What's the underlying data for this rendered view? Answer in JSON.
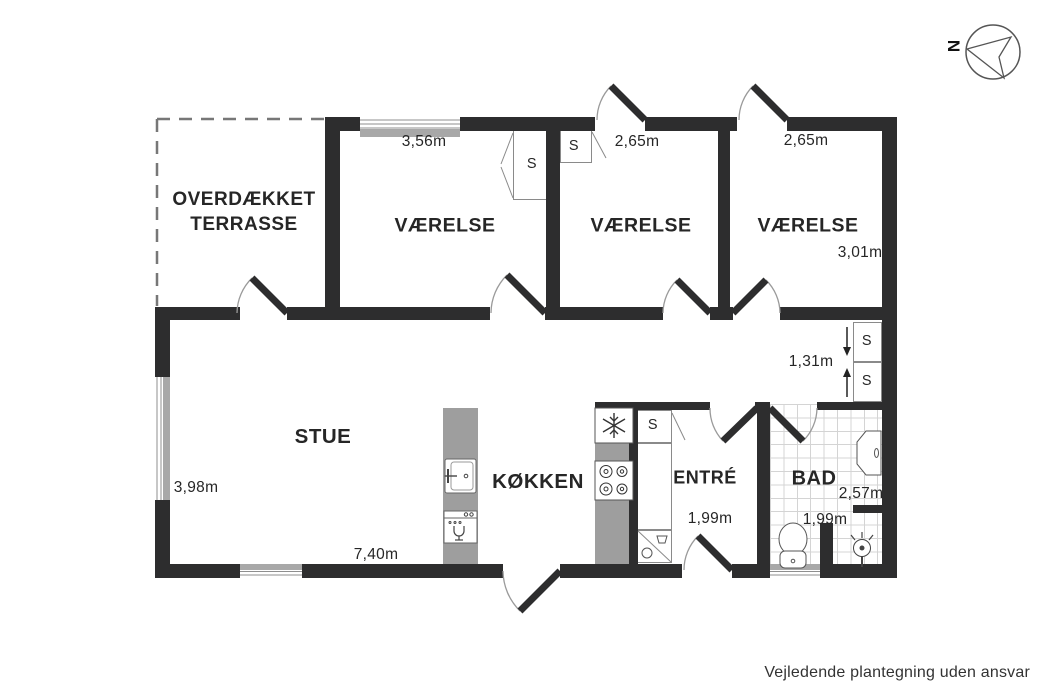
{
  "compass": {
    "north": "N"
  },
  "rooms": {
    "terrace": {
      "label": "OVERDÆKKET TERRASSE"
    },
    "vaerelse_1": {
      "label": "VÆRELSE",
      "width": "3,56m"
    },
    "vaerelse_2": {
      "label": "VÆRELSE",
      "width": "2,65m"
    },
    "vaerelse_3": {
      "label": "VÆRELSE",
      "width": "2,65m",
      "depth": "3,01m"
    },
    "hallway": {
      "depth": "1,31m"
    },
    "stue": {
      "label": "STUE",
      "depth": "3,98m",
      "width": "7,40m"
    },
    "kokken": {
      "label": "KØKKEN"
    },
    "entre": {
      "label": "ENTRÉ",
      "width": "1,99m"
    },
    "bad": {
      "label": "BAD",
      "width": "2,57m",
      "depth": "1,99m"
    }
  },
  "closet_label": "S",
  "disclaimer": "Vejledende plantegning uden ansvar",
  "palette": {
    "wall": "#2d2d2e",
    "counter_gray": "#9e9e9e",
    "tile_line": "#d4d4d4",
    "text": "#262626"
  }
}
